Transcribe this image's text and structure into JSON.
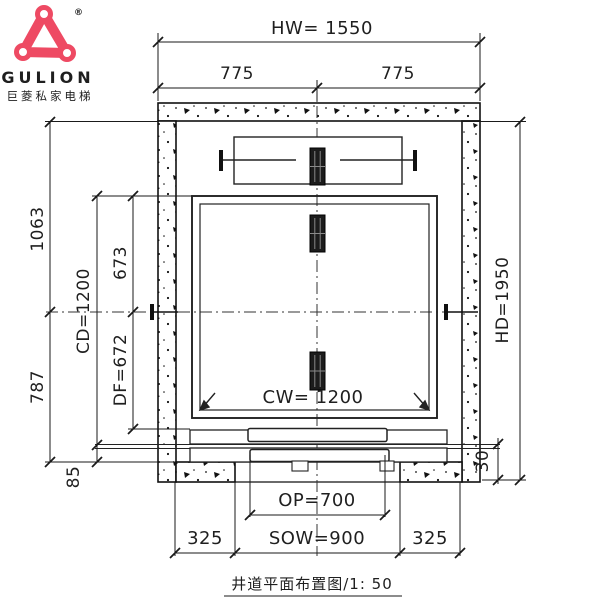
{
  "page": {
    "background": "#ffffff",
    "line_color": "#1a1a1a",
    "accent_color": "#ee4a63"
  },
  "logo": {
    "brand": "GULION",
    "tagline": "巨菱私家电梯",
    "registered": "®",
    "brand_color": "#ee4a63",
    "tagline_color": "#e03a50",
    "icon": "rounded-triangle-with-corner-circles"
  },
  "dimensions": {
    "top": {
      "hoistway_width": "HW= 1550",
      "left_half": "775",
      "right_half": "775"
    },
    "left": {
      "upper_outer": "1063",
      "lower_outer": "787",
      "car_depth": "CD=1200",
      "upper_inner": "673",
      "df": "DF=672",
      "sill_offset": "85"
    },
    "right": {
      "hoistway_depth": "HD=1950",
      "sill_projection": "30"
    },
    "inner": {
      "car_width": "CW= 1200"
    },
    "bottom": {
      "opening": "OP=700",
      "structural_opening_width": "SOW=900",
      "left_pier": "325",
      "right_pier": "325"
    }
  },
  "caption": {
    "title": "井道平面布置图/1: 50"
  }
}
